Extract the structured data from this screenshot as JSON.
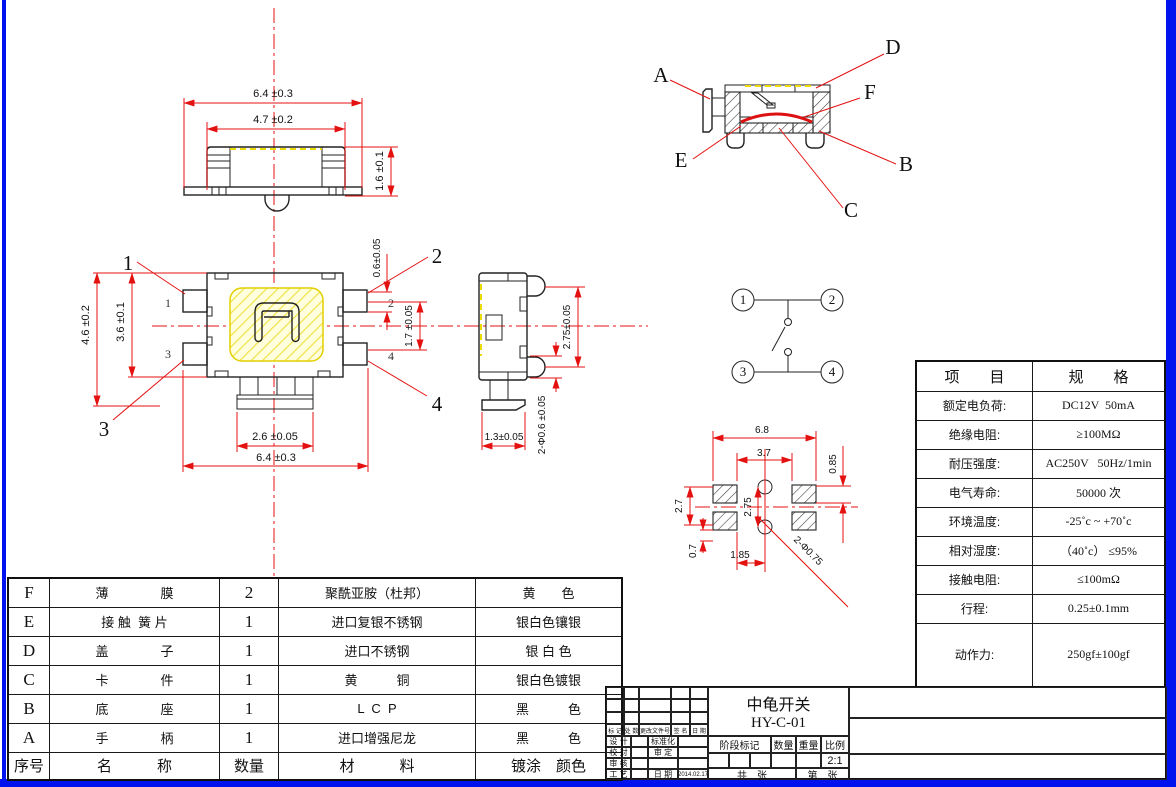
{
  "front_view": {
    "dim_width_outer": "6.4 ±0.3",
    "dim_width_inner": "4.7 ±0.2",
    "dim_height": "1.6 ±0.1"
  },
  "top_view": {
    "dim_height_outer": "4.6 ±0.2",
    "dim_height_inner": "3.6 ±0.1",
    "dim_pin_width": "0.6±0.05",
    "dim_pin_span": "1.7 ±0.05",
    "dim_tab_width": "2.6 ±0.05",
    "dim_width_outer": "6.4 ±0.3",
    "pin_labels": {
      "p1": "1",
      "p2": "2",
      "p3": "3",
      "p4": "4"
    },
    "callouts": {
      "c1": "1",
      "c2": "2",
      "c3": "3",
      "c4": "4"
    }
  },
  "side_view": {
    "dim_bump_span": "2.75±0.05",
    "dim_foot_width": "1.3±0.05",
    "dim_bump_dia": "2-Φ0.6 ±0.05"
  },
  "section_view": {
    "labels": {
      "a": "A",
      "b": "B",
      "c": "C",
      "d": "D",
      "e": "E",
      "f": "F"
    }
  },
  "circuit": {
    "terminals": {
      "t1": "1",
      "t2": "2",
      "t3": "3",
      "t4": "4"
    }
  },
  "footprint": {
    "dim_width_outer": "6.8",
    "dim_width_inner": "3.7",
    "dim_pad_height": "0.85",
    "dim_pad_span": "2.7",
    "dim_hole_pitch": "2.75",
    "dim_edge": "0.7",
    "dim_offset": "1.85",
    "dim_hole_dia": "2-Φ0.75"
  },
  "spec_table": {
    "col_item": "项　　目",
    "col_spec": "规　　格",
    "rows": [
      {
        "item": "额定电负荷:",
        "spec": "DC12V  50mA"
      },
      {
        "item": "绝缘电阻:",
        "spec": "≥100MΩ"
      },
      {
        "item": "耐压强度:",
        "spec": "AC250V   50Hz/1min"
      },
      {
        "item": "电气寿命:",
        "spec": "50000 次"
      },
      {
        "item": "环境温度:",
        "spec": "-25˚c ~ +70˚c"
      },
      {
        "item": "相对湿度:",
        "spec": "（40˚c） ≤95%"
      },
      {
        "item": "接触电阻:",
        "spec": "≤100mΩ"
      },
      {
        "item": "行程:",
        "spec": "0.25±0.1mm"
      },
      {
        "item": "动作力:",
        "spec": "250gf±100gf"
      }
    ]
  },
  "bom_table": {
    "rows": [
      {
        "id": "F",
        "name": "薄　　　　膜",
        "qty": "2",
        "material": "聚酰亚胺（杜邦）",
        "finish": "黄　　色"
      },
      {
        "id": "E",
        "name": "接 触  簧 片",
        "qty": "1",
        "material": "进口复银不锈钢",
        "finish": "银白色镶银"
      },
      {
        "id": "D",
        "name": "盖　　　　子",
        "qty": "1",
        "material": "进口不锈钢",
        "finish": "银 白 色"
      },
      {
        "id": "C",
        "name": "卡　　　　件",
        "qty": "1",
        "material": "黄　　　铜",
        "finish": "银白色镀银"
      },
      {
        "id": "B",
        "name": "底　　　　座",
        "qty": "1",
        "material": "L  C  P",
        "finish": "黑　　　色"
      },
      {
        "id": "A",
        "name": "手　　　　柄",
        "qty": "1",
        "material": "进口增强尼龙",
        "finish": "黑　　　色"
      }
    ],
    "footer": {
      "id": "序号",
      "name": "名　　　称",
      "qty": "数量",
      "material": "材　　　料",
      "finish": "镀涂　颜色"
    }
  },
  "title_block": {
    "title": "中龟开关",
    "part_no": "HY-C-01",
    "rev_headers": [
      "标 记",
      "处 数",
      "更改文件号",
      "签 名",
      "日 期"
    ],
    "sig_rows": [
      {
        "l": "设 计",
        "m": "标准化",
        "v": ""
      },
      {
        "l": "校 对",
        "m": "审 定",
        "v": ""
      },
      {
        "l": "审 核",
        "m": "",
        "v": ""
      },
      {
        "l": "工 艺",
        "m": "日 期",
        "v": "2014.02.17"
      }
    ],
    "stage_label": "阶段标记",
    "qty_label": "数量",
    "weight_label": "重量",
    "scale_label": "比例",
    "scale_value": "2:1",
    "sheet_total": "共　张",
    "sheet_no": "第　张"
  }
}
